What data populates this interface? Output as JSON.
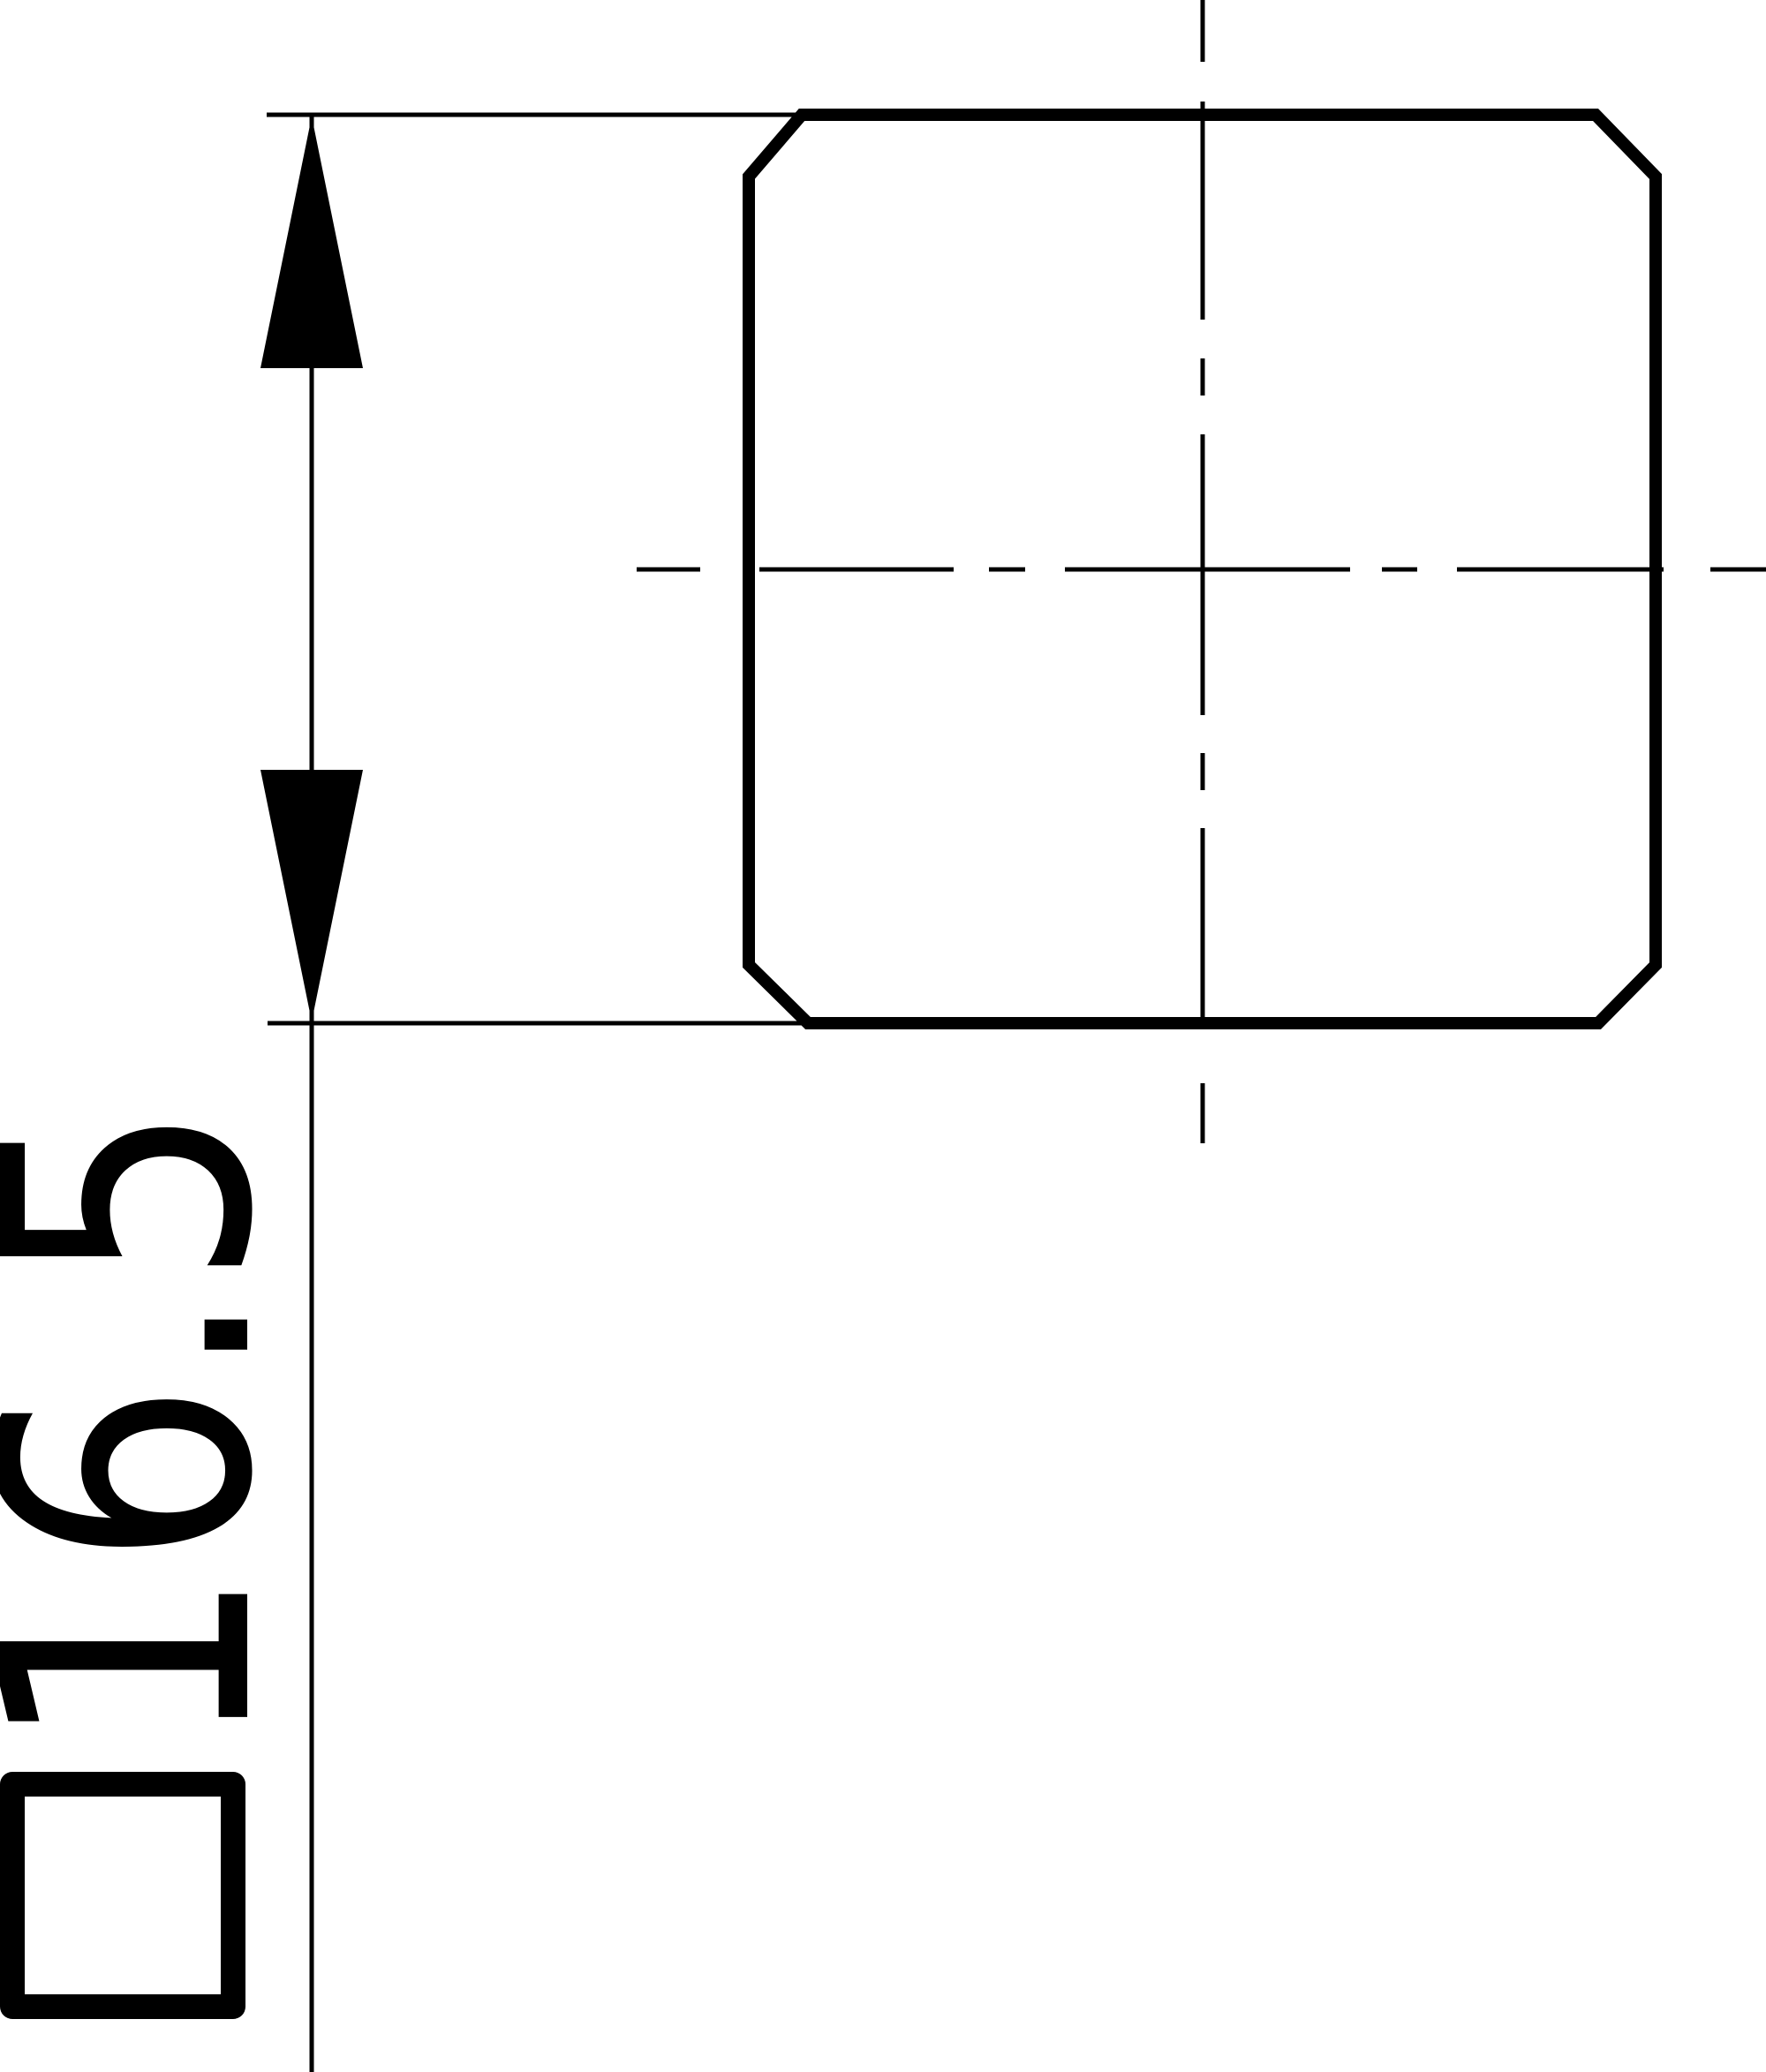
{
  "drawing": {
    "colors": {
      "ink": "#000000",
      "background": "#ffffff"
    },
    "dimension": {
      "symbol": "□",
      "value": "16.5",
      "label": "□16.5"
    }
  }
}
